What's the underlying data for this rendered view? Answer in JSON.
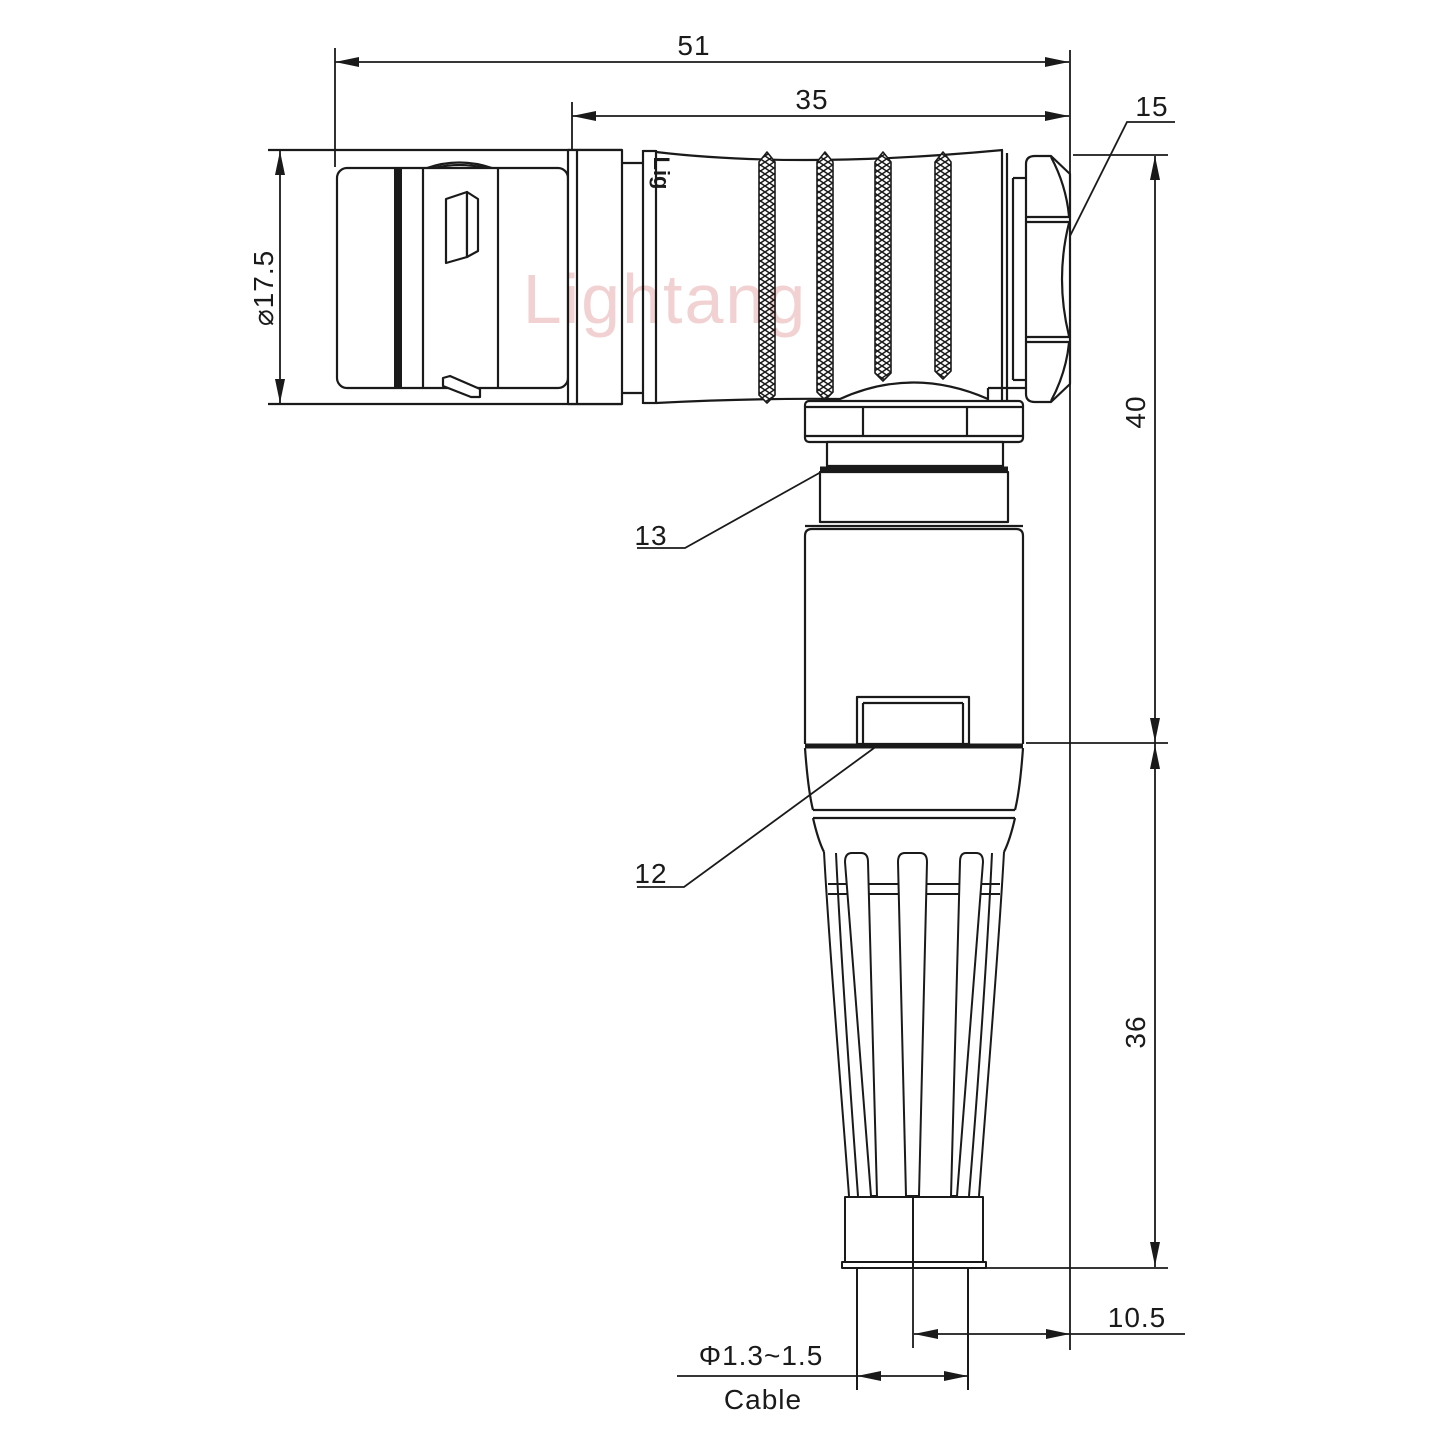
{
  "drawing": {
    "watermark": "Lightang",
    "body_marking": "Lig",
    "dimensions": {
      "overall_length": "51",
      "rear_body_length": "35",
      "hex_nut_ref": "15",
      "front_diameter": "⌀17.5",
      "elbow_height_upper": "40",
      "strain_relief_height": "36",
      "cable_offset": "10.5",
      "cable_diameter": "Φ1.3~1.5",
      "cable_label": "Cable",
      "ref_13": "13",
      "ref_12": "12"
    },
    "colors": {
      "line": "#1a1a1a",
      "watermark": "#e9b4b4",
      "background": "#ffffff"
    }
  }
}
